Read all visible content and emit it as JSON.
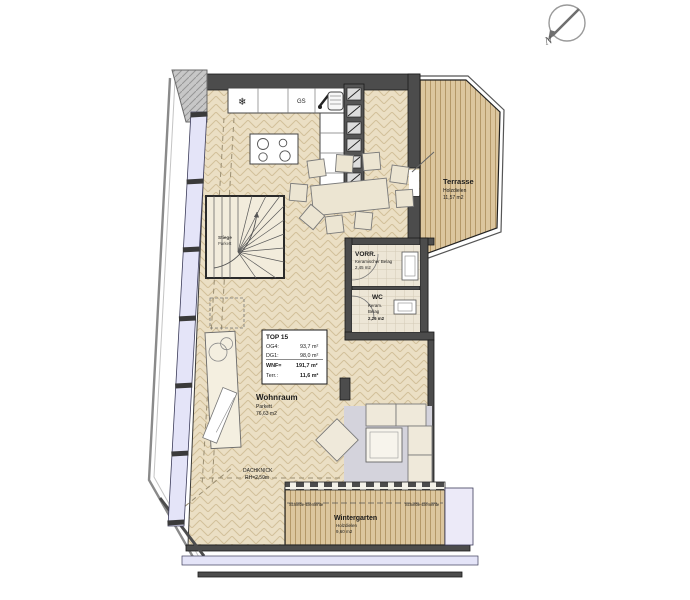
{
  "compass": {
    "north_label": "N"
  },
  "rooms": {
    "terrasse": {
      "name": "Terrasse",
      "floor": "Holzdielen",
      "area": "11,57 m2"
    },
    "vorraum": {
      "name": "VORR.",
      "floor": "Keramischer Belag",
      "area": "2,45 m2"
    },
    "wc": {
      "name": "WC",
      "floor_line1": "Keram.",
      "floor_line2": "Belag",
      "area": "2,26 m2"
    },
    "wohnraum": {
      "name": "Wohnraum",
      "floor": "Parkett",
      "area": "76,63 m2"
    },
    "wintergarten": {
      "name": "Wintergarten",
      "floor": "Holzdielen",
      "area": "9,60 m2"
    },
    "stiege": {
      "name": "Stiege",
      "floor": "Parkett"
    }
  },
  "info_box": {
    "title": "TOP 15",
    "rows": [
      {
        "label": "OG4:",
        "value": "93,7 m²"
      },
      {
        "label": "DG1:",
        "value": "98,0 m²"
      },
      {
        "label": "WNF=",
        "value": "191,7 m²"
      },
      {
        "label": "Terr.:",
        "value": "11,6 m²"
      }
    ]
  },
  "annotations": {
    "schiebe_elemente_left": "Schiebe-Elemente",
    "schiebe_elemente_right": "Schiebe-Elemente",
    "dachknick_line1": "DACHKNICK",
    "dachknick_line2": "RH=2,50m",
    "dishwasher_label": "GS",
    "freezer_symbol": "❄"
  },
  "colors": {
    "floor_tan": "#ebdfc4",
    "plank_tan": "#dcc69e",
    "wall_dark": "#4c4c4c",
    "window_lavender": "#e4e4f8",
    "rug_gray": "#d4d3dc"
  }
}
